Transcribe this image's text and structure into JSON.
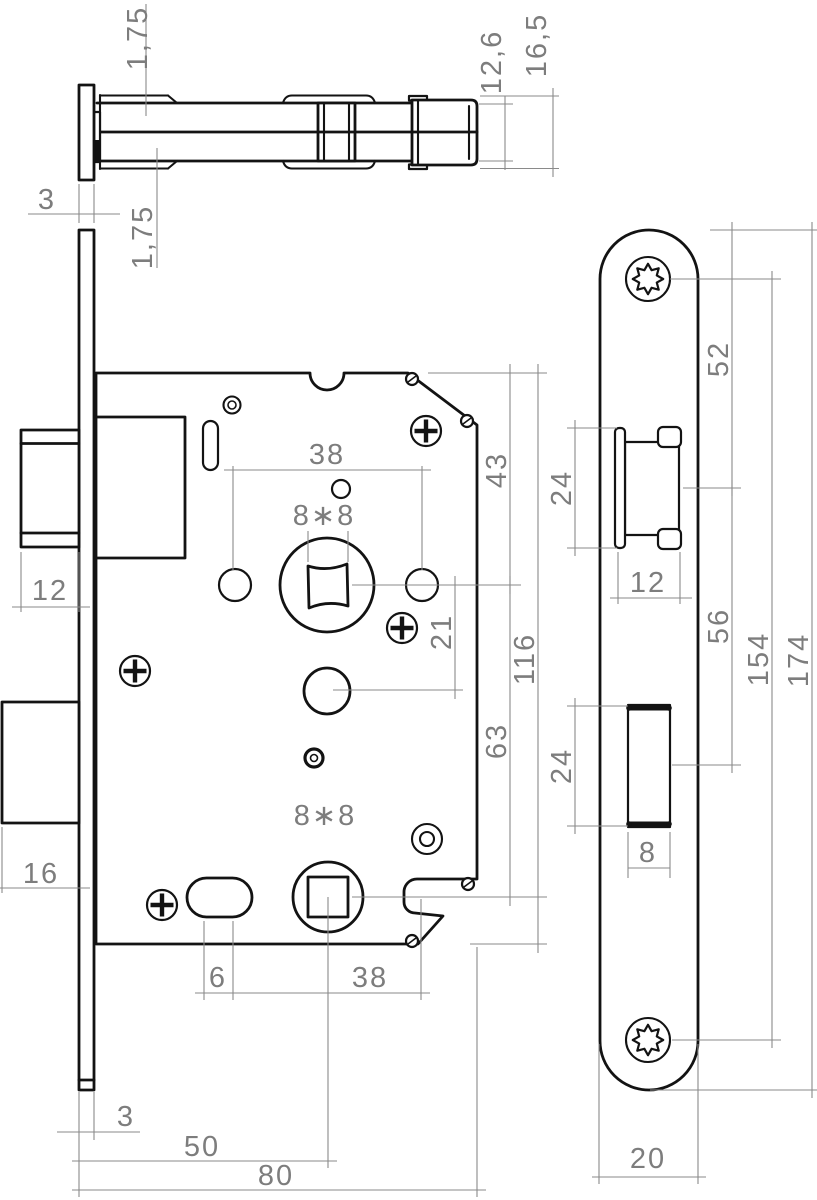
{
  "drawing": {
    "kind": "mortise-lock-technical-drawing",
    "units": "mm"
  },
  "dims": {
    "top": {
      "overhang_top": "1,75",
      "faceplate_thickness": "3",
      "overhang_bottom": "1,75",
      "inner_depth": "12,6",
      "outer_depth": "16,5"
    },
    "front": {
      "latch_width": "12",
      "upper_spacing": "38",
      "upper_square": "8∗8",
      "edge_to_hub": "43",
      "hub_to_hole": "21",
      "case_height": "116",
      "hub_to_spindle": "63",
      "deadbolt_throw": "16",
      "lower_square": "8∗8",
      "slot_offset": "6",
      "lower_spacing": "38",
      "plate_thickness": "3",
      "backset": "50",
      "case_depth": "80"
    },
    "plate": {
      "top_to_latch": "52",
      "latch_height": "24",
      "latch_width": "12",
      "latch_to_bolt": "56",
      "screw_spacing": "154",
      "plate_height": "174",
      "bolt_height": "24",
      "bolt_width": "8",
      "plate_width": "20"
    }
  }
}
